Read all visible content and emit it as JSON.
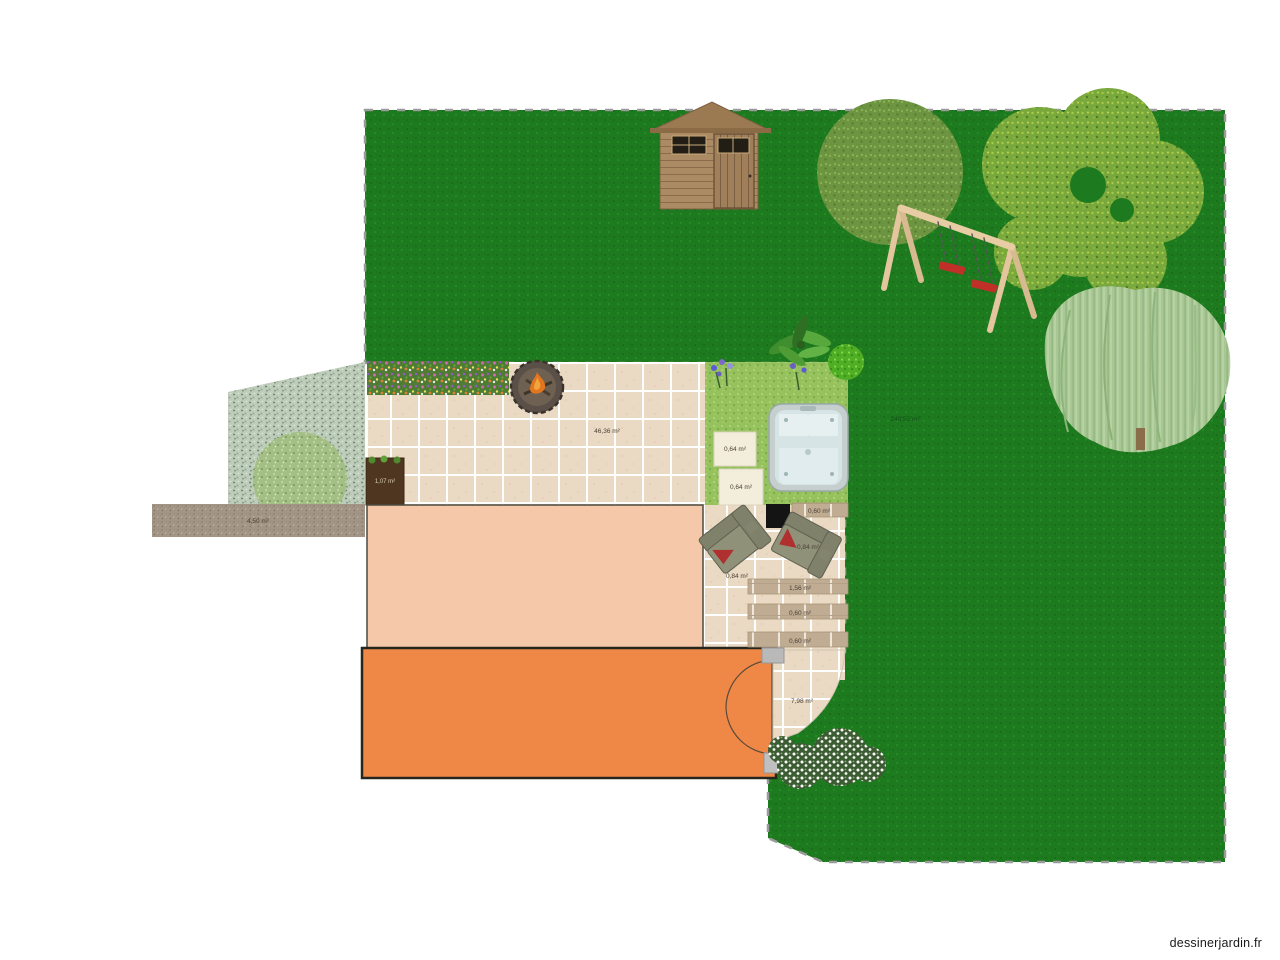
{
  "watermark": "dessinerjardin.fr",
  "labels": {
    "lawn_area": "240,52 m²",
    "patio_area": "46,36 m²",
    "stepping_stone_1": "0,64 m²",
    "stepping_stone_2": "0,64 m²",
    "planter_area": "1,07 m²",
    "gravel_area": "4,50 m²",
    "small_patio_area": "7,98 m²",
    "plank_1": "0,60 m²",
    "plank_2": "1,56 m²",
    "plank_3": "0,60 m²",
    "plank_4": "0,60 m²",
    "sofa_1": "0,84 m²",
    "sofa_2": "0,84 m²"
  },
  "colors": {
    "lawn_green": "#1e7a1e",
    "light_grass": "#96c25e",
    "patio_tile": "#ead9c3",
    "house_fill": "#f6c8aa",
    "terrace_orange": "#ef8747",
    "shed_wood": "#ab8b63",
    "swing_seat_red": "#c03028",
    "hot_tub_water": "#d7e4e6",
    "selection_dash": "#9a9a9a"
  }
}
